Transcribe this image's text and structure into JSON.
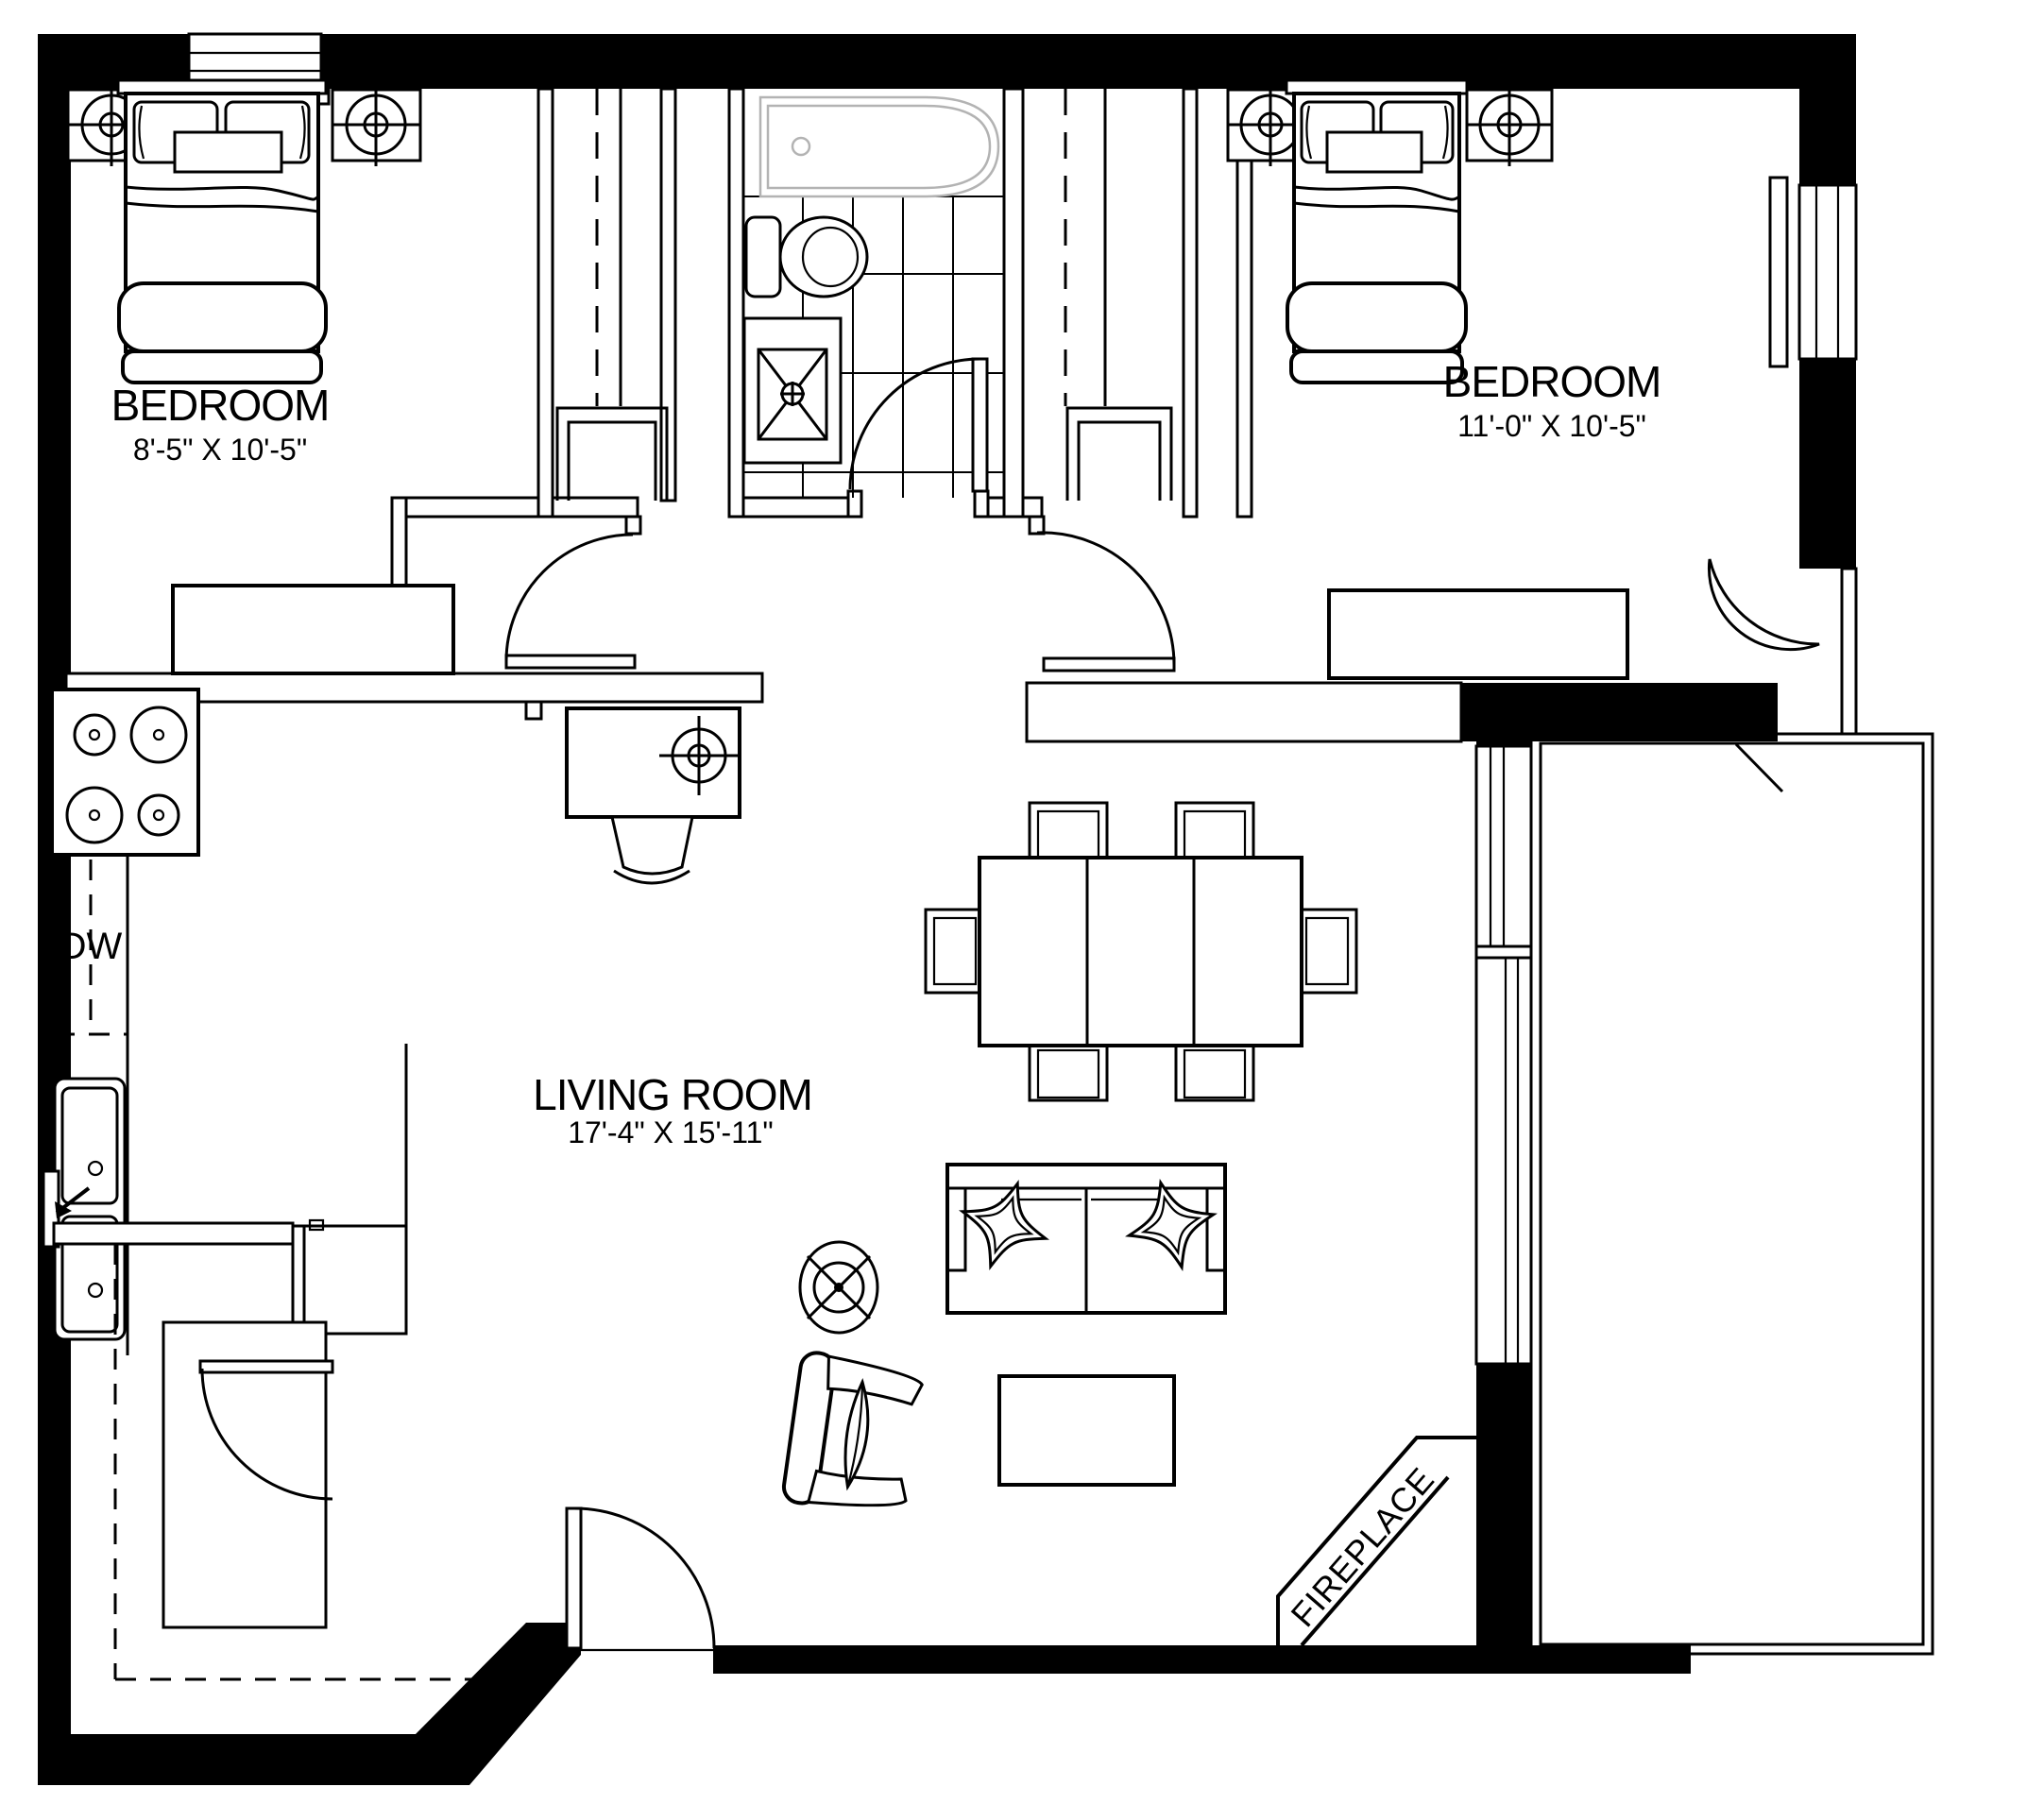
{
  "rooms": {
    "bedroom1": {
      "name": "BEDROOM",
      "dimensions": "8'-5\" X 10'-5\""
    },
    "bedroom2": {
      "name": "BEDROOM",
      "dimensions": "11'-0\" X 10'-5\""
    },
    "living_room": {
      "name": "LIVING ROOM",
      "dimensions": "17'-4\" X 15'-11\""
    }
  },
  "labels": {
    "dishwasher": "DW",
    "fireplace": "FIREPLACE"
  },
  "colors": {
    "wall": "#000000",
    "line": "#000000",
    "background": "#ffffff",
    "bathtub_outline": "#b3b3b3"
  }
}
